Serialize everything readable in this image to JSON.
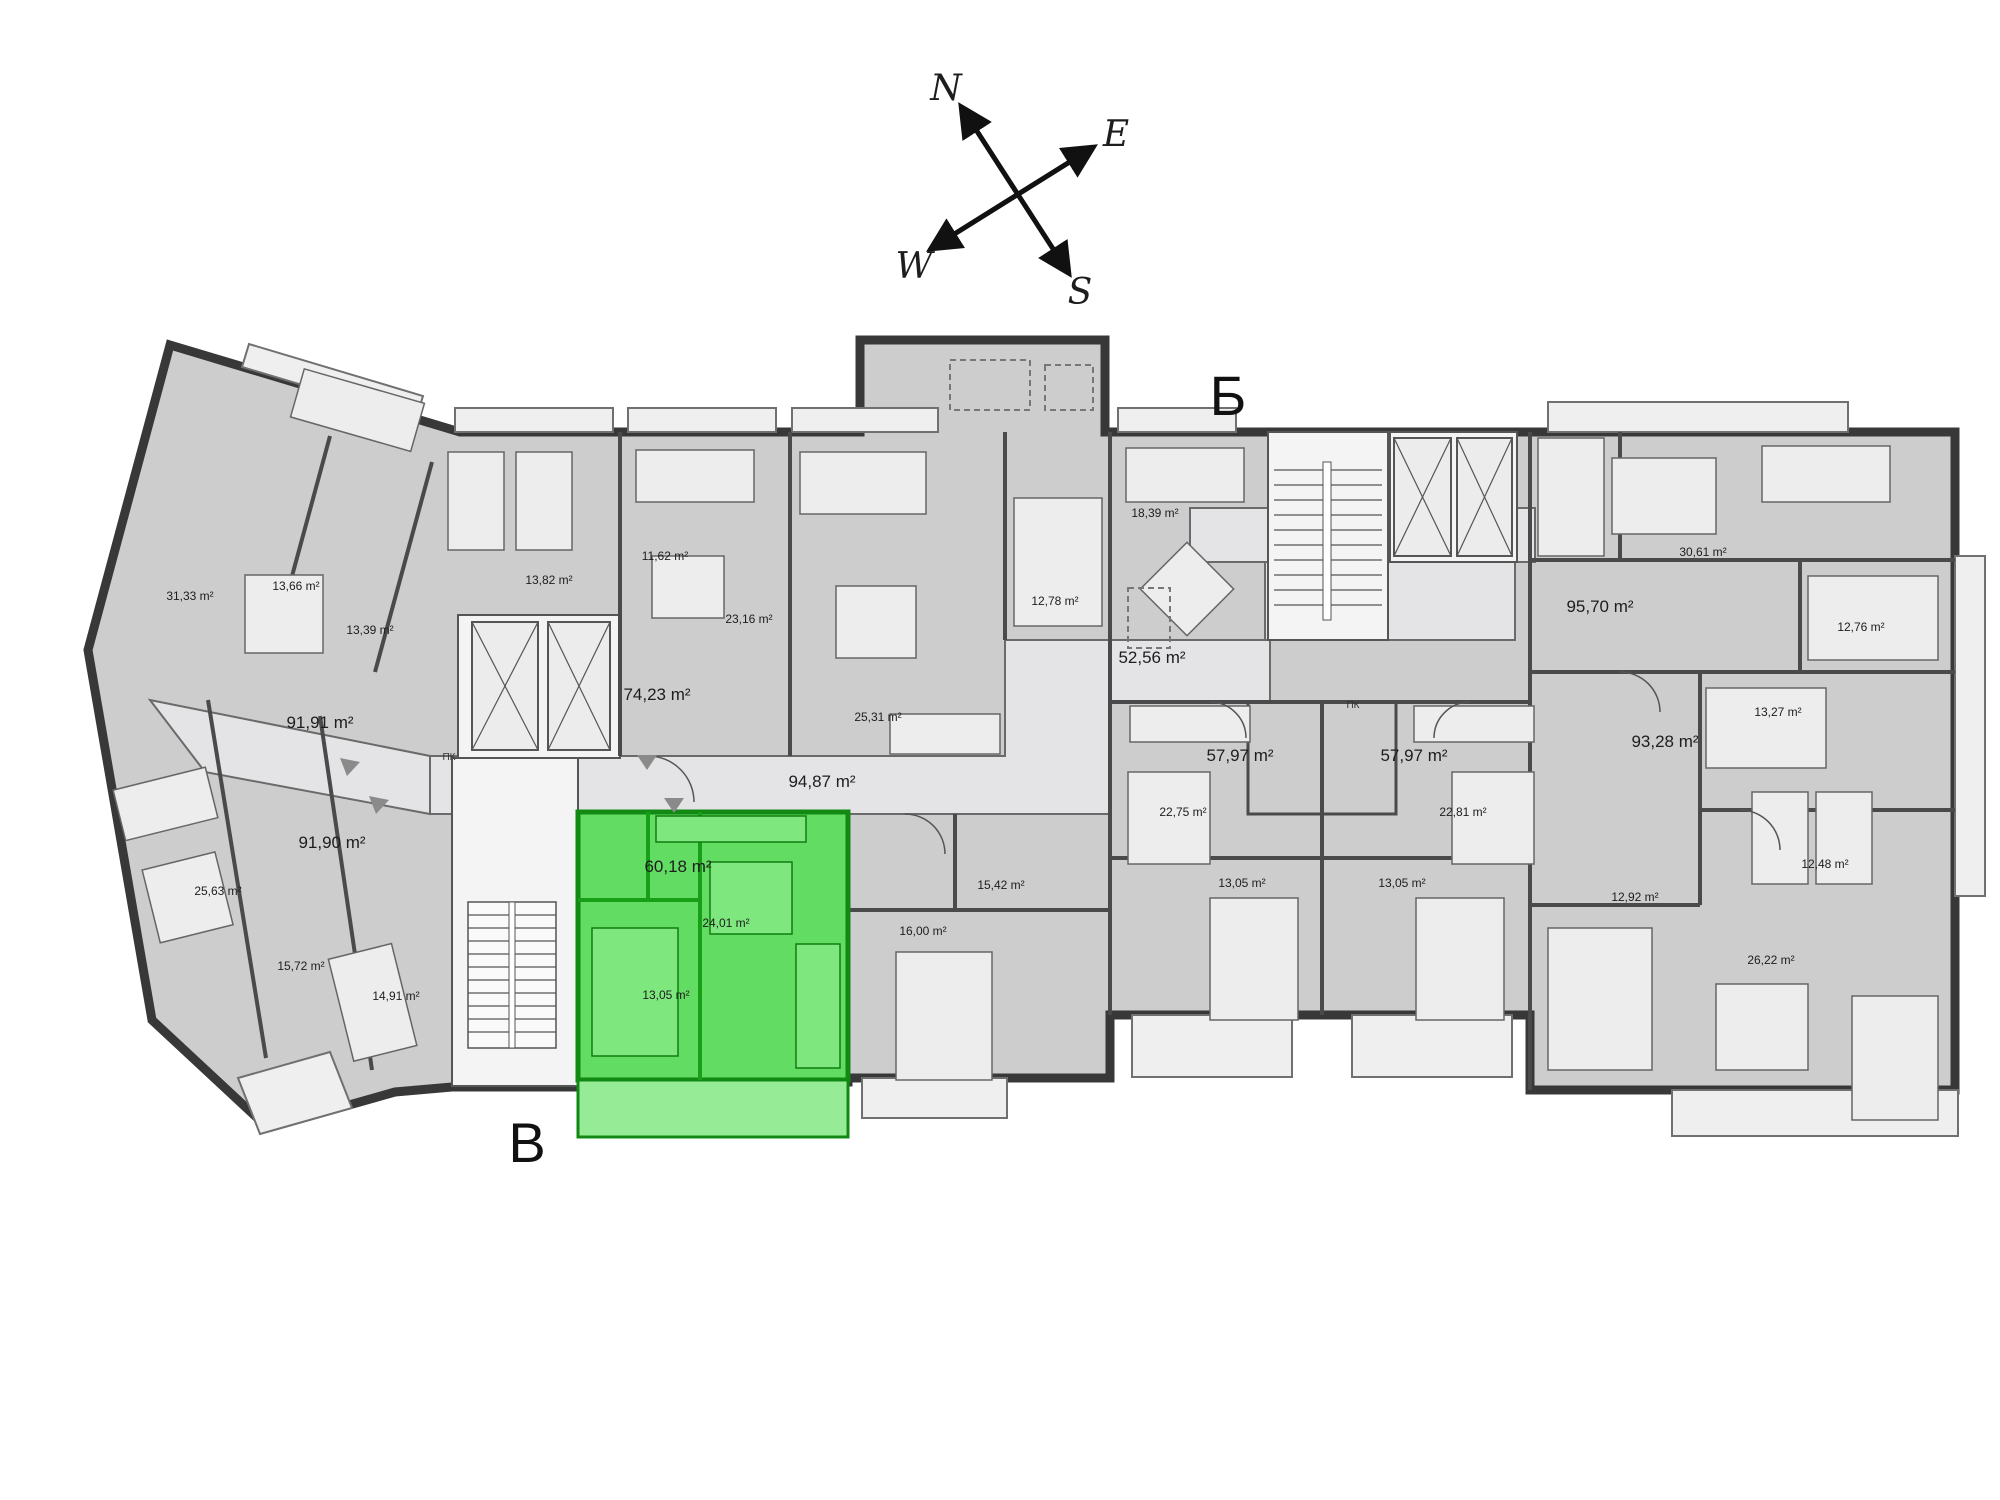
{
  "title": "Apartment building floor plan",
  "compass": {
    "n": "N",
    "e": "E",
    "w": "W",
    "s": "S",
    "n_color": "#2323cc",
    "s_color": "#cc1515",
    "ew_color": "#111111"
  },
  "sections": [
    {
      "id": "entrance-b",
      "label": "Б",
      "x": 1228,
      "y": 415
    },
    {
      "id": "entrance-v",
      "label": "В",
      "x": 527,
      "y": 1162
    }
  ],
  "highlight": {
    "fill": "#63DC63",
    "balcony_fill": "#96EC96",
    "wall": "#128912",
    "total_area": "60,18 m²"
  },
  "area_labels": [
    {
      "label": "31,33 m²",
      "x": 190,
      "y": 600,
      "lg": false
    },
    {
      "label": "13,66 m²",
      "x": 296,
      "y": 590,
      "lg": false
    },
    {
      "label": "13,39 m²",
      "x": 370,
      "y": 634,
      "lg": false
    },
    {
      "label": "13,82 m²",
      "x": 549,
      "y": 584,
      "lg": false
    },
    {
      "label": "11,62 m²",
      "x": 665,
      "y": 560,
      "lg": false
    },
    {
      "label": "23,16 m²",
      "x": 749,
      "y": 623,
      "lg": false
    },
    {
      "label": "74,23 m²",
      "x": 657,
      "y": 700,
      "lg": true
    },
    {
      "label": "25,31 m²",
      "x": 878,
      "y": 721,
      "lg": false
    },
    {
      "label": "12,78 m²",
      "x": 1055,
      "y": 605,
      "lg": false
    },
    {
      "label": "18,39 m²",
      "x": 1155,
      "y": 517,
      "lg": false
    },
    {
      "label": "52,56 m²",
      "x": 1152,
      "y": 663,
      "lg": true
    },
    {
      "label": "95,70 m²",
      "x": 1600,
      "y": 612,
      "lg": true
    },
    {
      "label": "30,61 m²",
      "x": 1703,
      "y": 556,
      "lg": false
    },
    {
      "label": "12,76 m²",
      "x": 1861,
      "y": 631,
      "lg": false
    },
    {
      "label": "13,27 m²",
      "x": 1778,
      "y": 716,
      "lg": false
    },
    {
      "label": "93,28 m²",
      "x": 1665,
      "y": 747,
      "lg": true
    },
    {
      "label": "57,97 m²",
      "x": 1240,
      "y": 761,
      "lg": true
    },
    {
      "label": "57,97 m²",
      "x": 1414,
      "y": 761,
      "lg": true
    },
    {
      "label": "22,75 m²",
      "x": 1183,
      "y": 816,
      "lg": false
    },
    {
      "label": "22,81 m²",
      "x": 1463,
      "y": 816,
      "lg": false
    },
    {
      "label": "13,05 m²",
      "x": 1242,
      "y": 887,
      "lg": false
    },
    {
      "label": "13,05 m²",
      "x": 1402,
      "y": 887,
      "lg": false
    },
    {
      "label": "12,48 m²",
      "x": 1825,
      "y": 868,
      "lg": false
    },
    {
      "label": "12,92 m²",
      "x": 1635,
      "y": 901,
      "lg": false
    },
    {
      "label": "26,22 m²",
      "x": 1771,
      "y": 964,
      "lg": false
    },
    {
      "label": "91,91 m²",
      "x": 320,
      "y": 728,
      "lg": true
    },
    {
      "label": "91,90 m²",
      "x": 332,
      "y": 848,
      "lg": true
    },
    {
      "label": "25,63 m²",
      "x": 218,
      "y": 895,
      "lg": false
    },
    {
      "label": "15,72 m²",
      "x": 301,
      "y": 970,
      "lg": false
    },
    {
      "label": "14,91 m²",
      "x": 396,
      "y": 1000,
      "lg": false
    },
    {
      "label": "94,87 m²",
      "x": 822,
      "y": 787,
      "lg": true
    },
    {
      "label": "15,42 m²",
      "x": 1001,
      "y": 889,
      "lg": false
    },
    {
      "label": "16,00 m²",
      "x": 923,
      "y": 935,
      "lg": false
    }
  ],
  "highlight_labels": [
    {
      "label": "60,18 m²",
      "x": 678,
      "y": 872,
      "lg": true
    },
    {
      "label": "24,01 m²",
      "x": 726,
      "y": 927,
      "lg": false
    },
    {
      "label": "13,05 m²",
      "x": 666,
      "y": 999,
      "lg": false
    }
  ],
  "utility_labels": [
    {
      "label": "ПК",
      "x": 449,
      "y": 760
    },
    {
      "label": "ПК",
      "x": 1353,
      "y": 708
    }
  ]
}
